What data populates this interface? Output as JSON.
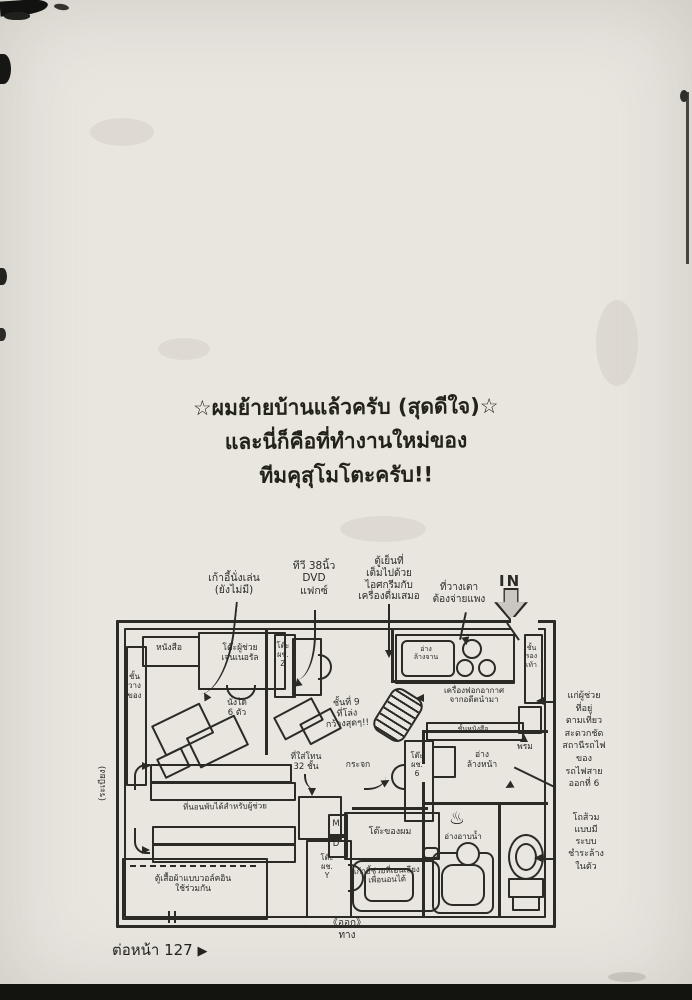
{
  "caption": {
    "line1": "☆ผมย้ายบ้านแล้วครับ (สุดดีใจ)☆",
    "line2": "และนี่ก็คือที่ทำงานใหม่ของ",
    "line3": "ทีมคุสุโมโตะครับ!!"
  },
  "notes": {
    "chair": "เก้าอี้นั่งเล่น\n(ยังไม่มี)",
    "tv": "ทีวี 38นิ้ว\nDVD\nแฟกซ์",
    "fridge": "ตู้เย็นที่\nเต็มไปด้วย\nไอศกรีมกับ\nเครื่องดื่มเสมอ",
    "stove": "ที่วางเตา\nต้องจ่ายแพง",
    "in": "IN",
    "purifier": "เครื่องฟอกอากาศ\nจากอดีตนำมา",
    "floor9": "ชั้นที่ 9\nที่โล่ง\nกว้างสุดๆ!!",
    "mirror": "กระจก",
    "tone": "ที่ใส่โทน\n32 ชั้น",
    "futon": "ที่นอนพับได้สำหรับผู้ช่วย",
    "recliner": "เก้าอี้ช่วยที่เอนเอียง\nเพื่อนอนได้",
    "assistant": "แก่ผู้ช่วย\nที่อยู่\nตามเที่ยว\nสะดวกชัด\nสถานีรถไฟ\nของ\nรถไฟสาย\nออกที่ 6",
    "toilet": "โถส้วม\nแบบมี\nระบบ\nชำระล้าง\nในตัว",
    "exit": "《ออก》\nทาง"
  },
  "rooms": {
    "books": "หนังสือ",
    "shelf_left": "ชั้น\nวาง\nของ",
    "desk_general": "โต๊ะผู้ช่วย\nเจนเนอรัล",
    "table_seats": "นั่งได้\n6 ตัว",
    "desk_z": "โต๊ะ\nผช.\nZ",
    "sink": "อ่าง\nล้างจาน",
    "shoe_shelf": "ชั้น\nรอง\nเท้า",
    "mat": "พรม",
    "towel_shelf": "ชั้นหนังสือ",
    "washbasin": "อ่าง\nล้างหน้า",
    "bath_icon": "♨",
    "bath": "อ่างอาบน้ำ",
    "desk_6": "โต๊ะ\nผช.\n6",
    "md_m": "M",
    "md_d": "D",
    "desk_my": "โต๊ะของผม",
    "desk_y": "โต๊ะ\nผช.\nY",
    "closet": "ตู้เสื้อผ้าแบบวอล์คอิน\nใช้ร่วมกัน",
    "balcony": "(ระเบียง)"
  },
  "footer": {
    "continue": "ต่อหน้า 127",
    "arrow": "▶"
  }
}
